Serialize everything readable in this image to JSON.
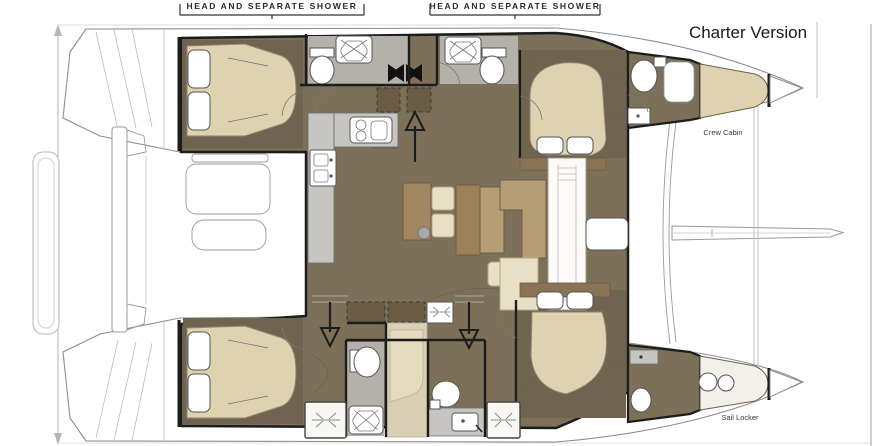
{
  "diagram": {
    "type": "catamaran-floor-plan",
    "title": "Charter Version",
    "beam_dimension_label": "Bmax = 8000",
    "head_labels": {
      "port_aft": "HEAD AND SEPARATE SHOWER",
      "port_forward": "HEAD AND SEPARATE SHOWER"
    },
    "compartment_labels": {
      "crew_cabin": "Crew Cabin",
      "sail_locker": "Sail Locker"
    },
    "colors": {
      "interior_floor": "#7c7158",
      "cabin_floor_dark": "#6e6450",
      "mattress_cream": "#ded2b0",
      "corridor_cream": "#d9cfb4",
      "seat_cream": "#e7dfc6",
      "wood_tan": "#b59d74",
      "wood_tan_dark": "#9c8259",
      "locker_brown": "#6b5d45",
      "headboard_brown": "#8a7354",
      "counter_gray": "#c6c5c1",
      "head_floor_gray": "#b3b1aa",
      "wall_black": "#1c1c1c",
      "hull_outline": "#8e8e8e"
    },
    "icons": {
      "mast": "double-bowtie",
      "stairs_up": "arrow-up",
      "stairs_down": "arrow-down",
      "shower": "square-with-x-drain",
      "toilet": "oval-with-tank",
      "stove": "two-burners-and-oven",
      "sink": "basin-with-faucet",
      "deck_hatch": "cross-tick-glyph"
    }
  }
}
